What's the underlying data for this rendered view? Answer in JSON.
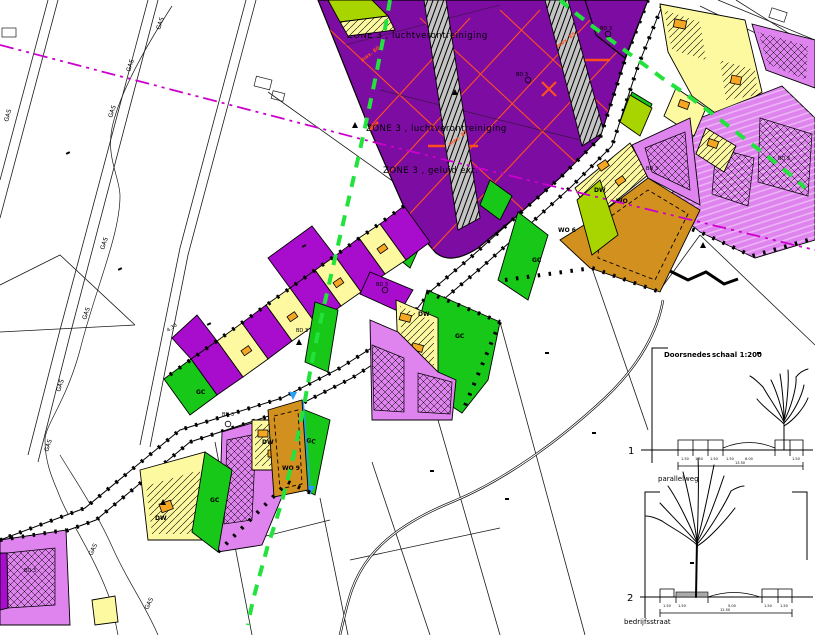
{
  "zones": {
    "z1": "ZONE 3 , luchtverontreiniging",
    "z2": "ZONE 3 , luchtverontreiniging",
    "z3": "ZONE 3 , geluid ext."
  },
  "codes": {
    "gc": "GC",
    "dw": "DW",
    "bd": "BD 3",
    "wo": "WO",
    "wo6": "WO 6",
    "wo9": "WO 9",
    "gas": "GAS",
    "dim430": "4.30",
    "max80": "max. 80",
    "max87": "max. 87",
    "max85": "max. 85"
  },
  "sections": {
    "title": "Doorsnedes",
    "scale": "schaal 1:200",
    "one": {
      "num": "1",
      "street": "parallelweg",
      "dims": [
        "1.50",
        "1.50",
        "1.50",
        "1.50",
        "6.00",
        "1.50"
      ],
      "total": "13.50"
    },
    "two": {
      "num": "2",
      "street": "bedrijfsstraat",
      "dims": [
        "1.50",
        "1.50",
        "5.00",
        "1.50",
        "1.50"
      ],
      "total": "12.50"
    }
  },
  "colors": {
    "parcel_purple_dark": "#7c0ca2",
    "parcel_purple": "#a80ccc",
    "parcel_pink": "#df83ef",
    "parcel_yellow": "#fdf9a0",
    "parcel_green": "#18c818",
    "parcel_yellowgreen": "#a8d400",
    "parcel_orange": "#d2901e",
    "building_orange": "#f5a623",
    "buffer_gray": "#c4c4c4",
    "line_magenta": "#cc00cc",
    "line_green": "#22e23c",
    "line_blue": "#2a9df4",
    "line_orange": "#ff4f1f"
  }
}
